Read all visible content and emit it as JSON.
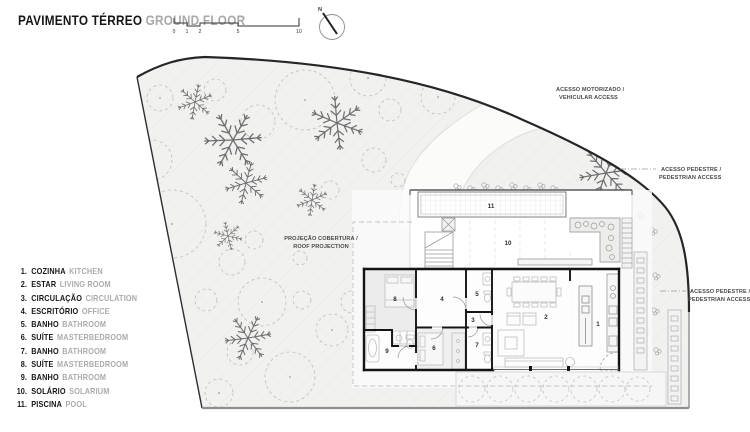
{
  "header": {
    "title_pt": "PAVIMENTO TÉRREO",
    "title_en": "GROUND FLOOR",
    "north_label": "N",
    "scale_ticks": [
      "0",
      "1",
      "2",
      "5",
      "10"
    ]
  },
  "legend": {
    "items": [
      {
        "num": "1.",
        "pt": "COZINHA",
        "en": "KITCHEN"
      },
      {
        "num": "2.",
        "pt": "ESTAR",
        "en": "LIVING ROOM"
      },
      {
        "num": "3.",
        "pt": "CIRCULAÇÃO",
        "en": "CIRCULATION"
      },
      {
        "num": "4.",
        "pt": "ESCRITÓRIO",
        "en": "OFFICE"
      },
      {
        "num": "5.",
        "pt": "BANHO",
        "en": "BATHROOM"
      },
      {
        "num": "6.",
        "pt": "SUÍTE",
        "en": "MASTERBEDROOM"
      },
      {
        "num": "7.",
        "pt": "BANHO",
        "en": "BATHROOM"
      },
      {
        "num": "8.",
        "pt": "SUÍTE",
        "en": "MASTERBEDROOM"
      },
      {
        "num": "9.",
        "pt": "BANHO",
        "en": "BATHROOM"
      },
      {
        "num": "10.",
        "pt": "SOLÁRIO",
        "en": "SOLARIUM"
      },
      {
        "num": "11.",
        "pt": "PISCINA",
        "en": "POOL"
      }
    ]
  },
  "annotations": {
    "vehicular": {
      "line1": "ACESSO MOTORIZADO /",
      "line2": "VEHICULAR ACCESS"
    },
    "pedestrian_upper": {
      "line1": "ACESSO PEDESTRE /",
      "line2": "PEDESTRIAN ACCESS"
    },
    "pedestrian_lower": {
      "line1": "ACESSO PEDESTRE /",
      "line2": "PEDESTRIAN ACCESS"
    },
    "roof": {
      "line1": "PROJEÇÃO COBERTURA /",
      "line2": "ROOF PROJECTION"
    }
  },
  "plan": {
    "room_numbers": [
      "1",
      "2",
      "3",
      "4",
      "5",
      "6",
      "7",
      "8",
      "9",
      "10",
      "11"
    ]
  },
  "colors": {
    "boundary": "#262626",
    "site_fill": "#f1f1f0",
    "wall": "#141414",
    "furniture": "#bdbdbd",
    "tree_dash": "#bdbdbd",
    "fern": "#6e6e6e",
    "text_dark": "#161616",
    "text_gray": "#a8a8a8"
  }
}
